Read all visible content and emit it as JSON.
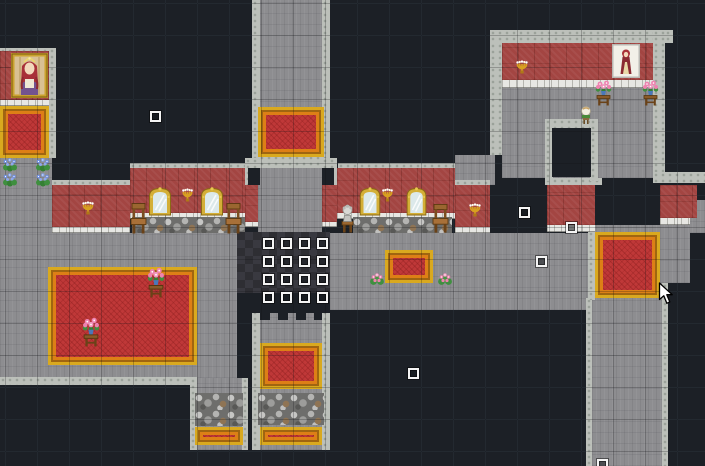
{
  "app": {
    "name": "castle-interior-map",
    "view": "game-map"
  },
  "viewport": {
    "width": 705,
    "height": 466
  },
  "grid": {
    "tile_size": 32,
    "offset_x": 5,
    "offset_y": 3
  },
  "palette": {
    "dark_wall": "#1c2026",
    "dark_grid_line": "#2a313a",
    "floor_gray": "#8d8d90",
    "stone_trim": "#bcc0ba",
    "red_wall": "#a34542",
    "shelf_white": "#e7e7e3",
    "carpet_red": "#bf3838",
    "carpet_gold": "#d9a91f",
    "carpet_orange": "#dd7f16",
    "rubble_gray": "#9d9d9b",
    "diamond_floor": "#2e2e33",
    "event_border": "#f4f4f4"
  },
  "map": {
    "regions": [
      {
        "type": "floor",
        "x": 0,
        "y": 155,
        "w": 52,
        "h": 78
      },
      {
        "type": "floor",
        "x": 0,
        "y": 233,
        "w": 237,
        "h": 145
      },
      {
        "type": "floor",
        "x": 197,
        "y": 378,
        "w": 45,
        "h": 72
      },
      {
        "type": "floor",
        "x": 260,
        "y": 0,
        "w": 62,
        "h": 168
      },
      {
        "type": "floor",
        "x": 258,
        "y": 168,
        "w": 64,
        "h": 65
      },
      {
        "type": "floor",
        "x": 260,
        "y": 310,
        "w": 62,
        "h": 140
      },
      {
        "type": "floor",
        "x": 330,
        "y": 233,
        "w": 263,
        "h": 77
      },
      {
        "type": "floor",
        "x": 455,
        "y": 155,
        "w": 40,
        "h": 30
      },
      {
        "type": "floor",
        "x": 502,
        "y": 83,
        "w": 151,
        "h": 95
      },
      {
        "type": "floor",
        "x": 688,
        "y": 200,
        "w": 17,
        "h": 33
      },
      {
        "type": "floor",
        "x": 588,
        "y": 225,
        "w": 102,
        "h": 58
      },
      {
        "type": "floor",
        "x": 592,
        "y": 283,
        "w": 70,
        "h": 183
      },
      {
        "type": "stone",
        "x": 0,
        "y": 48,
        "w": 56,
        "h": 5
      },
      {
        "type": "stone",
        "x": 49,
        "y": 48,
        "w": 7,
        "h": 110
      },
      {
        "type": "stone",
        "x": 52,
        "y": 180,
        "w": 78,
        "h": 5
      },
      {
        "type": "stone",
        "x": 130,
        "y": 163,
        "w": 123,
        "h": 5
      },
      {
        "type": "stone",
        "x": 252,
        "y": 0,
        "w": 8,
        "h": 158
      },
      {
        "type": "stone",
        "x": 322,
        "y": 0,
        "w": 8,
        "h": 158
      },
      {
        "type": "stone",
        "x": 252,
        "y": 155,
        "w": 78,
        "h": 13
      },
      {
        "type": "stone",
        "x": 245,
        "y": 158,
        "w": 13,
        "h": 27
      },
      {
        "type": "stone",
        "x": 322,
        "y": 158,
        "w": 15,
        "h": 27
      },
      {
        "type": "stone",
        "x": 338,
        "y": 163,
        "w": 117,
        "h": 5
      },
      {
        "type": "stone",
        "x": 455,
        "y": 180,
        "w": 35,
        "h": 5
      },
      {
        "type": "stone",
        "x": 490,
        "y": 30,
        "w": 183,
        "h": 13
      },
      {
        "type": "stone",
        "x": 490,
        "y": 43,
        "w": 12,
        "h": 112
      },
      {
        "type": "stone",
        "x": 653,
        "y": 30,
        "w": 12,
        "h": 147
      },
      {
        "type": "stone",
        "x": 653,
        "y": 172,
        "w": 52,
        "h": 11
      },
      {
        "type": "stone",
        "x": 545,
        "y": 178,
        "w": 57,
        "h": 7
      },
      {
        "type": "stone",
        "x": 545,
        "y": 119,
        "w": 53,
        "h": 10
      },
      {
        "type": "stone",
        "x": 545,
        "y": 119,
        "w": 8,
        "h": 62
      },
      {
        "type": "stone",
        "x": 590,
        "y": 119,
        "w": 8,
        "h": 62
      },
      {
        "type": "stone",
        "x": 0,
        "y": 377,
        "w": 197,
        "h": 8
      },
      {
        "type": "stone",
        "x": 190,
        "y": 378,
        "w": 7,
        "h": 72
      },
      {
        "type": "stone",
        "x": 242,
        "y": 378,
        "w": 6,
        "h": 72
      },
      {
        "type": "stone",
        "x": 252,
        "y": 310,
        "w": 8,
        "h": 140
      },
      {
        "type": "stone",
        "x": 322,
        "y": 310,
        "w": 8,
        "h": 140
      },
      {
        "type": "stone",
        "x": 586,
        "y": 298,
        "w": 6,
        "h": 168
      },
      {
        "type": "stone",
        "x": 662,
        "y": 283,
        "w": 6,
        "h": 183
      },
      {
        "type": "stone",
        "x": 588,
        "y": 225,
        "w": 7,
        "h": 75
      },
      {
        "type": "redwall",
        "x": 0,
        "y": 51,
        "w": 49,
        "h": 49
      },
      {
        "type": "shelf",
        "x": 0,
        "y": 100,
        "w": 49,
        "h": 6
      },
      {
        "type": "redwall",
        "x": 52,
        "y": 185,
        "w": 78,
        "h": 42
      },
      {
        "type": "shelf",
        "x": 52,
        "y": 227,
        "w": 78,
        "h": 6
      },
      {
        "type": "redwall",
        "x": 130,
        "y": 168,
        "w": 115,
        "h": 45
      },
      {
        "type": "shelf",
        "x": 130,
        "y": 213,
        "w": 115,
        "h": 6
      },
      {
        "type": "redwall",
        "x": 245,
        "y": 185,
        "w": 13,
        "h": 37
      },
      {
        "type": "shelf",
        "x": 245,
        "y": 222,
        "w": 13,
        "h": 5
      },
      {
        "type": "redwall",
        "x": 322,
        "y": 185,
        "w": 15,
        "h": 37
      },
      {
        "type": "shelf",
        "x": 322,
        "y": 222,
        "w": 15,
        "h": 5
      },
      {
        "type": "redwall",
        "x": 337,
        "y": 168,
        "w": 118,
        "h": 45
      },
      {
        "type": "shelf",
        "x": 337,
        "y": 213,
        "w": 118,
        "h": 6
      },
      {
        "type": "redwall",
        "x": 455,
        "y": 185,
        "w": 35,
        "h": 42
      },
      {
        "type": "shelf",
        "x": 455,
        "y": 227,
        "w": 35,
        "h": 6
      },
      {
        "type": "redwall",
        "x": 502,
        "y": 43,
        "w": 151,
        "h": 37
      },
      {
        "type": "shelf",
        "x": 502,
        "y": 80,
        "w": 151,
        "h": 8
      },
      {
        "type": "redwall",
        "x": 547,
        "y": 185,
        "w": 48,
        "h": 40
      },
      {
        "type": "shelf",
        "x": 547,
        "y": 225,
        "w": 48,
        "h": 7
      },
      {
        "type": "redwall",
        "x": 660,
        "y": 185,
        "w": 37,
        "h": 33
      },
      {
        "type": "shelf",
        "x": 660,
        "y": 218,
        "w": 30,
        "h": 7
      },
      {
        "type": "rubble",
        "x": 132,
        "y": 217,
        "w": 113,
        "h": 16
      },
      {
        "type": "rubble",
        "x": 353,
        "y": 217,
        "w": 99,
        "h": 16
      },
      {
        "type": "rubble",
        "x": 195,
        "y": 393,
        "w": 48,
        "h": 33
      },
      {
        "type": "rubble",
        "x": 258,
        "y": 393,
        "w": 66,
        "h": 32
      },
      {
        "type": "diamond",
        "x": 237,
        "y": 232,
        "w": 93,
        "h": 63
      },
      {
        "type": "dark",
        "x": 552,
        "y": 128,
        "w": 39,
        "h": 49
      },
      {
        "type": "dark",
        "x": 237,
        "y": 293,
        "w": 93,
        "h": 20
      },
      {
        "type": "dark",
        "x": 260,
        "y": 308,
        "w": 10,
        "h": 12
      },
      {
        "type": "dark",
        "x": 278,
        "y": 308,
        "w": 10,
        "h": 12
      },
      {
        "type": "dark",
        "x": 296,
        "y": 308,
        "w": 10,
        "h": 12
      },
      {
        "type": "dark",
        "x": 314,
        "y": 308,
        "w": 8,
        "h": 12
      },
      {
        "type": "dark",
        "x": 248,
        "y": 168,
        "w": 12,
        "h": 17
      },
      {
        "type": "dark",
        "x": 322,
        "y": 168,
        "w": 12,
        "h": 17
      },
      {
        "type": "carpet",
        "x": 0,
        "y": 106,
        "w": 49,
        "h": 52
      },
      {
        "type": "carpet",
        "x": 258,
        "y": 107,
        "w": 66,
        "h": 50
      },
      {
        "type": "carpet",
        "x": 48,
        "y": 267,
        "w": 149,
        "h": 98
      },
      {
        "type": "carpet",
        "x": 385,
        "y": 250,
        "w": 48,
        "h": 33
      },
      {
        "type": "carpet",
        "x": 595,
        "y": 232,
        "w": 65,
        "h": 66
      },
      {
        "type": "carpet",
        "x": 260,
        "y": 343,
        "w": 62,
        "h": 46
      },
      {
        "type": "carpet",
        "x": 260,
        "y": 427,
        "w": 62,
        "h": 18
      },
      {
        "type": "carpet",
        "x": 195,
        "y": 427,
        "w": 48,
        "h": 18
      }
    ],
    "sprites": [
      {
        "type": "portrait-queen",
        "x": 11,
        "y": 53,
        "w": 37,
        "h": 45
      },
      {
        "type": "portrait-lady",
        "x": 612,
        "y": 44,
        "w": 28,
        "h": 34
      },
      {
        "type": "mirror",
        "x": 146,
        "y": 185,
        "w": 28,
        "h": 32
      },
      {
        "type": "mirror",
        "x": 198,
        "y": 185,
        "w": 28,
        "h": 32
      },
      {
        "type": "mirror",
        "x": 357,
        "y": 185,
        "w": 26,
        "h": 32
      },
      {
        "type": "mirror",
        "x": 404,
        "y": 185,
        "w": 25,
        "h": 32
      },
      {
        "type": "wall-sconce",
        "x": 80,
        "y": 200,
        "w": 16,
        "h": 16
      },
      {
        "type": "wall-sconce",
        "x": 180,
        "y": 187,
        "w": 15,
        "h": 16
      },
      {
        "type": "wall-sconce",
        "x": 380,
        "y": 187,
        "w": 15,
        "h": 16
      },
      {
        "type": "wall-sconce",
        "x": 467,
        "y": 202,
        "w": 16,
        "h": 16
      },
      {
        "type": "wall-sconce",
        "x": 514,
        "y": 59,
        "w": 16,
        "h": 16
      },
      {
        "type": "statue",
        "x": 340,
        "y": 203,
        "w": 15,
        "h": 30
      },
      {
        "type": "chair",
        "x": 130,
        "y": 202,
        "w": 17,
        "h": 34
      },
      {
        "type": "chair",
        "x": 225,
        "y": 202,
        "w": 17,
        "h": 34
      },
      {
        "type": "chair",
        "x": 432,
        "y": 203,
        "w": 17,
        "h": 32
      },
      {
        "type": "flower-table",
        "x": 595,
        "y": 80,
        "w": 17,
        "h": 26
      },
      {
        "type": "flower-table",
        "x": 642,
        "y": 80,
        "w": 17,
        "h": 26
      },
      {
        "type": "flower-table",
        "x": 147,
        "y": 267,
        "w": 18,
        "h": 31
      },
      {
        "type": "flower-table",
        "x": 82,
        "y": 317,
        "w": 18,
        "h": 30
      },
      {
        "type": "blue-flowers",
        "x": 2,
        "y": 157,
        "w": 16,
        "h": 15
      },
      {
        "type": "blue-flowers",
        "x": 35,
        "y": 157,
        "w": 16,
        "h": 15
      },
      {
        "type": "blue-flowers",
        "x": 2,
        "y": 172,
        "w": 16,
        "h": 15
      },
      {
        "type": "blue-flowers",
        "x": 35,
        "y": 172,
        "w": 16,
        "h": 15
      },
      {
        "type": "pink-bush",
        "x": 369,
        "y": 271,
        "w": 16,
        "h": 16
      },
      {
        "type": "pink-bush",
        "x": 437,
        "y": 271,
        "w": 16,
        "h": 16
      },
      {
        "type": "orb-stand",
        "x": 579,
        "y": 105,
        "w": 14,
        "h": 19
      }
    ],
    "event_markers": {
      "size": 11,
      "positions": [
        [
          263,
          238
        ],
        [
          281,
          238
        ],
        [
          299,
          238
        ],
        [
          317,
          238
        ],
        [
          263,
          256
        ],
        [
          281,
          256
        ],
        [
          299,
          256
        ],
        [
          317,
          256
        ],
        [
          263,
          274
        ],
        [
          281,
          274
        ],
        [
          299,
          274
        ],
        [
          317,
          274
        ],
        [
          263,
          292
        ],
        [
          281,
          292
        ],
        [
          299,
          292
        ],
        [
          317,
          292
        ],
        [
          150,
          111
        ],
        [
          519,
          207
        ],
        [
          566,
          222
        ],
        [
          536,
          256
        ],
        [
          408,
          368
        ],
        [
          597,
          459
        ]
      ]
    }
  },
  "cursor": {
    "x": 658,
    "y": 282,
    "w": 18,
    "h": 23
  }
}
